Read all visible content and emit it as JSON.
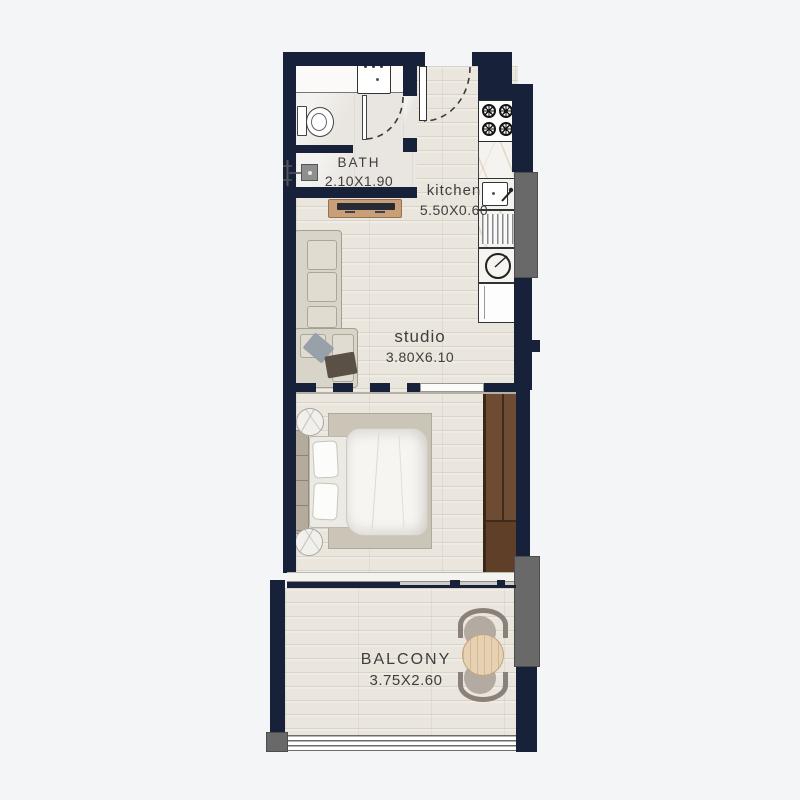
{
  "plan": {
    "type": "floor-plan",
    "unit": "studio apartment",
    "rooms": {
      "bath": {
        "label": "BATH",
        "dims": "2.10X1.90"
      },
      "kitchen": {
        "label": "kitchen",
        "dims": "5.50X0.60"
      },
      "studio": {
        "label": "studio",
        "dims": "3.80X6.10"
      },
      "balcony": {
        "label": "BALCONY",
        "dims": "3.75X2.60"
      }
    },
    "fixtures": [
      "entrance-door",
      "bathroom-door",
      "toilet",
      "vanity-sink",
      "shower",
      "tv-console",
      "sectional-sofa",
      "gas-stove",
      "kitchen-sink",
      "dish-drainer",
      "washing-machine",
      "fridge",
      "double-bed",
      "nightstand",
      "rug",
      "wardrobe",
      "sliding-balcony-door",
      "balcony-table",
      "balcony-chair",
      "railing",
      "service-duct"
    ],
    "colors": {
      "wall": "#17213a",
      "background": "#f4f5f6",
      "wood": "#eae5dd",
      "bath_floor": "#e9e6e1",
      "marble": "#f5f3ef",
      "wardrobe": "#6e4c34",
      "wardrobe_dark": "#5f3f28",
      "duct": "#696969",
      "sofa": "#d8d4c9",
      "rug": "#cbc5b8",
      "tan_wood": "#c89f77",
      "label_text": "#3e3e3e"
    }
  }
}
